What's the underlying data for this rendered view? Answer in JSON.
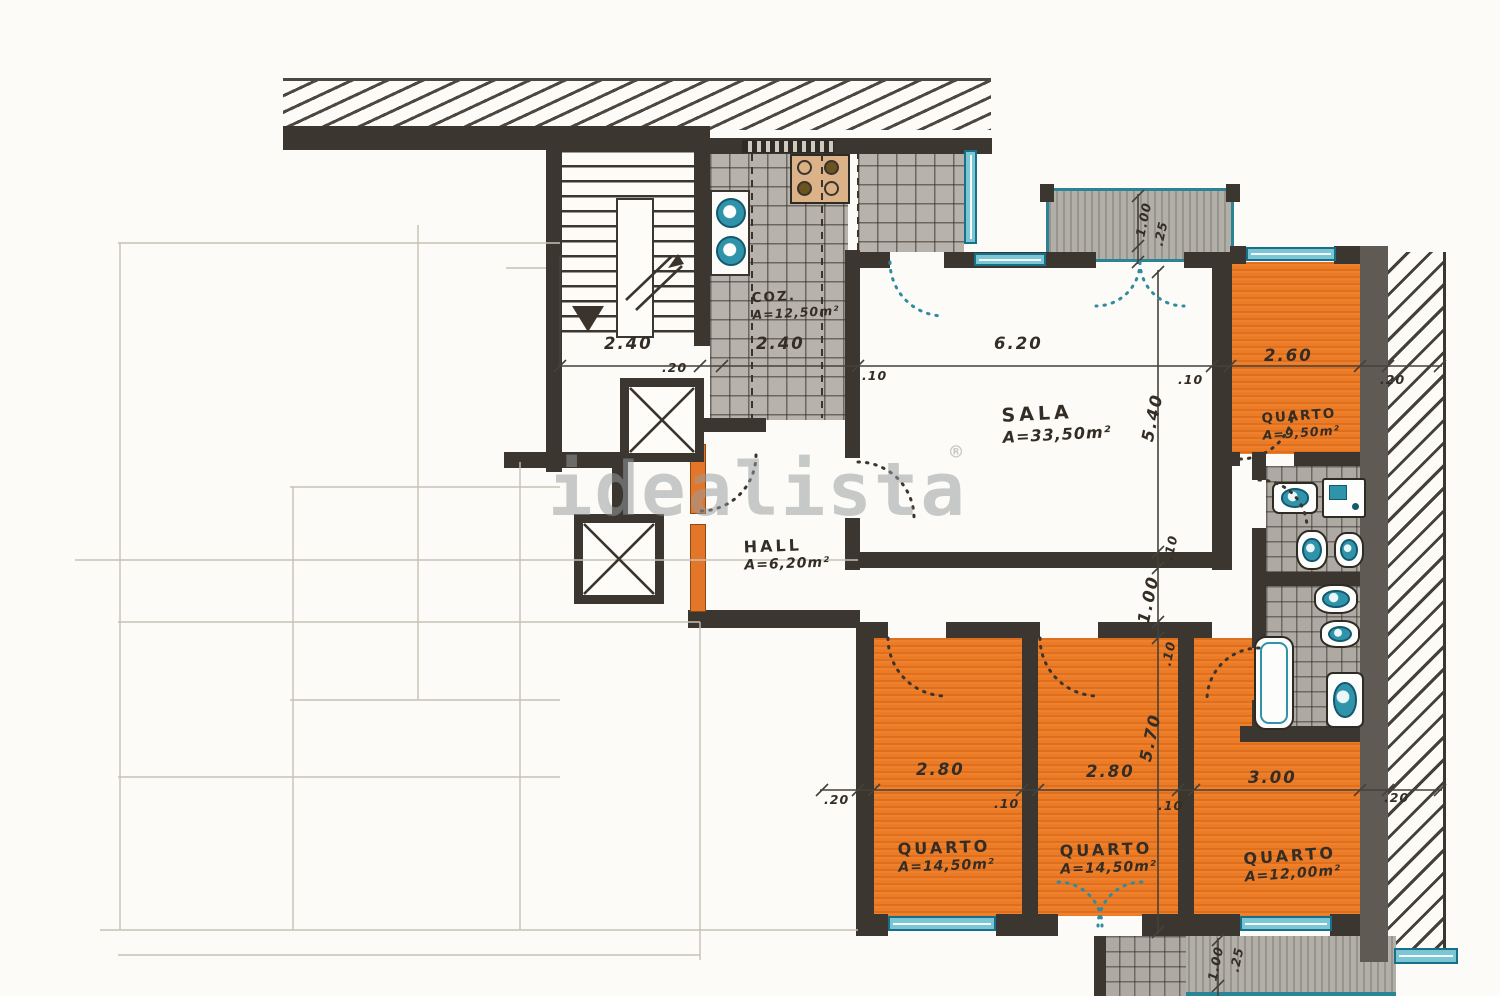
{
  "watermark": {
    "text": "idealista",
    "mark": "®"
  },
  "rooms": {
    "kitchen": {
      "name": "COZ.",
      "area": "A=12,50m²"
    },
    "living": {
      "name": "SALA",
      "area": "A=33,50m²"
    },
    "hall": {
      "name": "HALL",
      "area": "A=6,20m²"
    },
    "bedroom1": {
      "name": "QUARTO",
      "area": "A=9,50m²"
    },
    "bedroom2": {
      "name": "QUARTO",
      "area": "A=14,50m²"
    },
    "bedroom3": {
      "name": "QUARTO",
      "area": "A=14,50m²"
    },
    "bedroom4": {
      "name": "QUARTO",
      "area": "A=12,00m²"
    }
  },
  "dims": {
    "stair_width": "2.40",
    "stair_wall": ".20",
    "kitchen_width": "2.40",
    "kitchen_wall": ".10",
    "living_width": "6.20",
    "living_wall": ".10",
    "bedroom1_width": "2.60",
    "right_wall": ".20",
    "living_height": "5.40",
    "wall_top": ".10",
    "corridor": "1.00",
    "wall_bottom": ".10",
    "bedrooms_height": "5.70",
    "left_wall": ".20",
    "bedroom2_width": "2.80",
    "wall_a": ".10",
    "bedroom3_width": "2.80",
    "wall_b": ".10",
    "bedroom4_width": "3.00",
    "outer_wall": ".20",
    "balcony_top_depth": "1.00",
    "balcony_top_rail": ".25",
    "balcony_bottom_depth": "1.00",
    "balcony_bottom_rail": ".25"
  }
}
